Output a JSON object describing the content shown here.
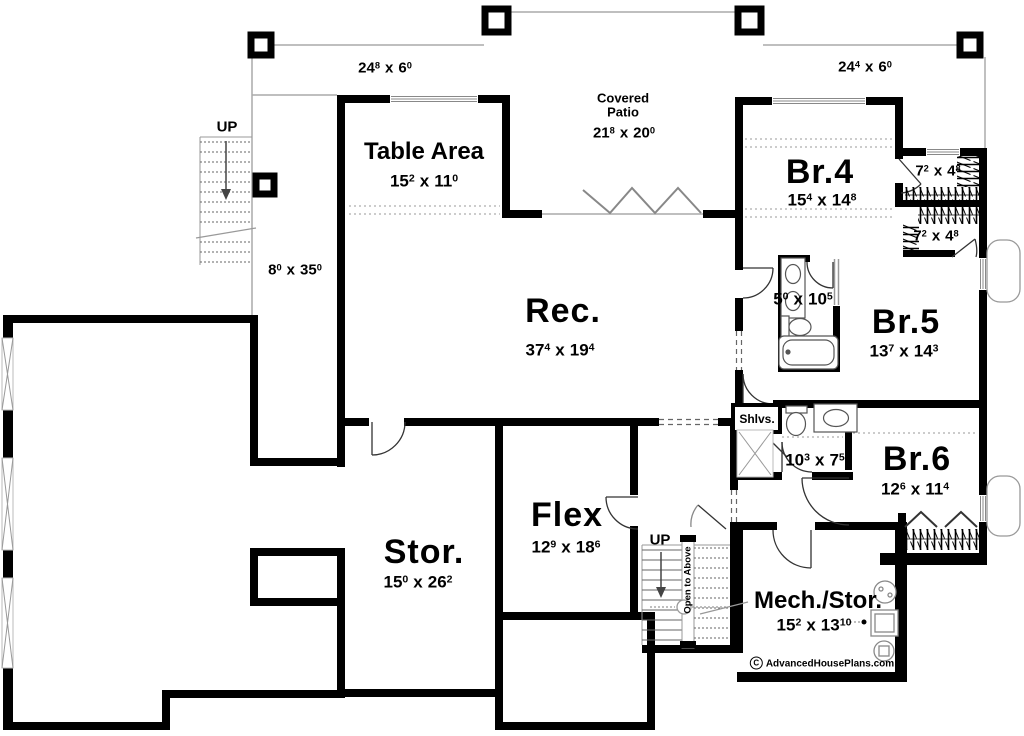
{
  "dim_sep": "x",
  "deck": {
    "left_dim": {
      "w": "24",
      "wi": "8",
      "h": "6",
      "hi": "0"
    },
    "right_dim": {
      "w": "24",
      "wi": "4",
      "h": "6",
      "hi": "0"
    },
    "side_dim": {
      "w": "8",
      "wi": "0",
      "h": "35",
      "hi": "0"
    }
  },
  "stairs": {
    "up_left": "UP",
    "up_center": "UP",
    "open_to_above": "Open to Above"
  },
  "rooms": {
    "table_area": {
      "name": "Table Area",
      "w": "15",
      "wi": "2",
      "h": "11",
      "hi": "0"
    },
    "covered_patio": {
      "line1": "Covered",
      "line2": "Patio",
      "w": "21",
      "wi": "8",
      "h": "20",
      "hi": "0"
    },
    "rec": {
      "name": "Rec.",
      "w": "37",
      "wi": "4",
      "h": "19",
      "hi": "4"
    },
    "br4": {
      "name": "Br.4",
      "w": "15",
      "wi": "4",
      "h": "14",
      "hi": "8"
    },
    "br5": {
      "name": "Br.5",
      "w": "13",
      "wi": "7",
      "h": "14",
      "hi": "3"
    },
    "br6": {
      "name": "Br.6",
      "w": "12",
      "wi": "6",
      "h": "11",
      "hi": "4"
    },
    "flex": {
      "name": "Flex",
      "w": "12",
      "wi": "9",
      "h": "18",
      "hi": "6"
    },
    "stor": {
      "name": "Stor.",
      "w": "15",
      "wi": "0",
      "h": "26",
      "hi": "2"
    },
    "mech": {
      "name": "Mech./Stor.",
      "w": "15",
      "wi": "2",
      "h": "13",
      "hi": "10"
    },
    "bath_main": {
      "w": "5",
      "wi": "0",
      "h": "10",
      "hi": "5"
    },
    "bath_hall": {
      "w": "10",
      "wi": "3",
      "h": "7",
      "hi": "5"
    },
    "closet_br4": {
      "w": "7",
      "wi": "2",
      "h": "4",
      "hi": "8"
    },
    "closet_br5": {
      "w": "7",
      "wi": "2",
      "h": "4",
      "hi": "8"
    }
  },
  "labels": {
    "shelves": "Shlvs."
  },
  "branding": {
    "copyright_symbol": "C",
    "site": "AdvancedHousePlans.com"
  }
}
